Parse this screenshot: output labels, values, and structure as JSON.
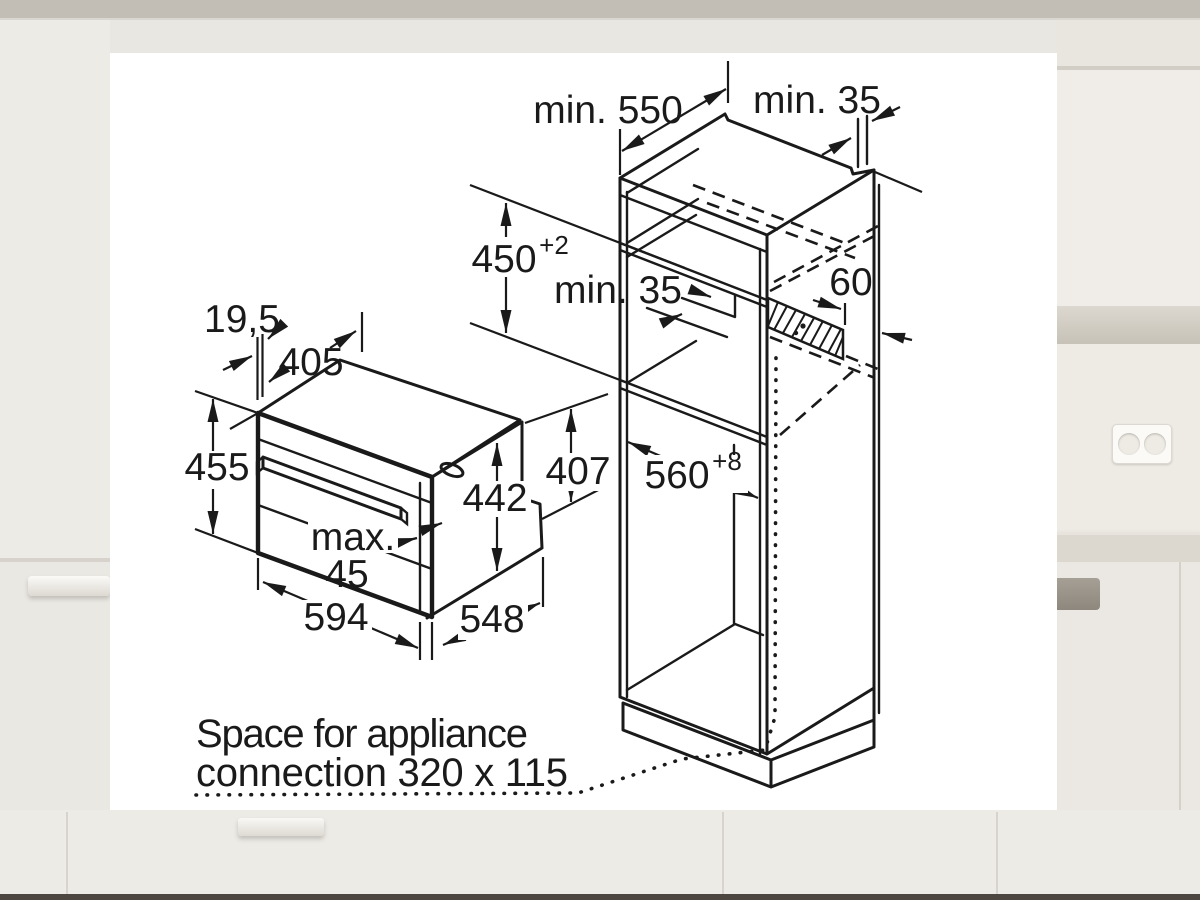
{
  "palette": {
    "panel_bg": "#ffffff",
    "line_color": "#1a1a1a",
    "kitchen_top_band": "#c2beb6",
    "kitchen_wall": "#f0ede8",
    "kitchen_cabinet": "#ebe8e3",
    "kitchen_counter": "#dcd7cf",
    "kitchen_plinth": "#4c4741"
  },
  "diagram": {
    "cabinet": {
      "depth_top": "min. 550",
      "wall_gap": "min. 35",
      "niche_height": "450",
      "niche_height_tol": "+2",
      "shelf_gap": "min. 35",
      "vent_width": "60",
      "niche_width": "560",
      "niche_width_tol": "+8"
    },
    "appliance": {
      "inset_depth": "19,5",
      "top_depth": "405",
      "height": "455",
      "front_height": "442",
      "rear_height": "407",
      "door_max_line1": "max.",
      "door_max_line2": "45",
      "width": "594",
      "depth": "548"
    },
    "note": {
      "line1": "Space for appliance",
      "line2": "connection 320 x 115"
    }
  }
}
